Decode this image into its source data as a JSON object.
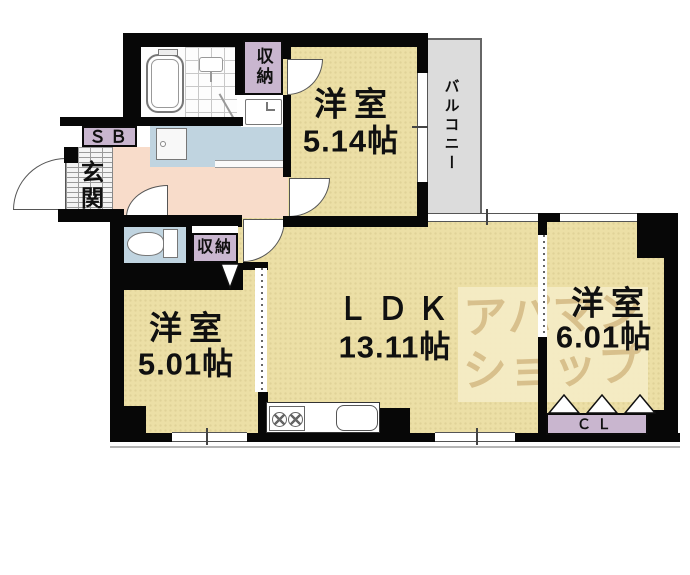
{
  "plan": {
    "rooms": [
      {
        "name": "洋室",
        "size": "5.14帖"
      },
      {
        "name": "ＬＤＫ",
        "size": "13.11帖"
      },
      {
        "name": "洋室",
        "size": "5.01帖"
      },
      {
        "name": "洋室",
        "size": "6.01帖"
      }
    ],
    "labels": {
      "balcony": "バルコニー",
      "entrance": "玄関",
      "shoe_box": "ＳＢ",
      "storage_upper": "収納",
      "storage_lower": "収納",
      "closet": "ＣＬ"
    },
    "watermark": {
      "line1": "アパマン",
      "line2": "ショップ"
    },
    "colors": {
      "floor": "#ecdfa6",
      "hallway": "#f8dcca",
      "wet_area": "#c0d4e0",
      "storage_box": "#c9b6cf",
      "balcony": "#dcdcdc",
      "wall": "#070707",
      "watermark_bg": "#f4ebc4",
      "watermark_text": "#d8c08c"
    }
  }
}
